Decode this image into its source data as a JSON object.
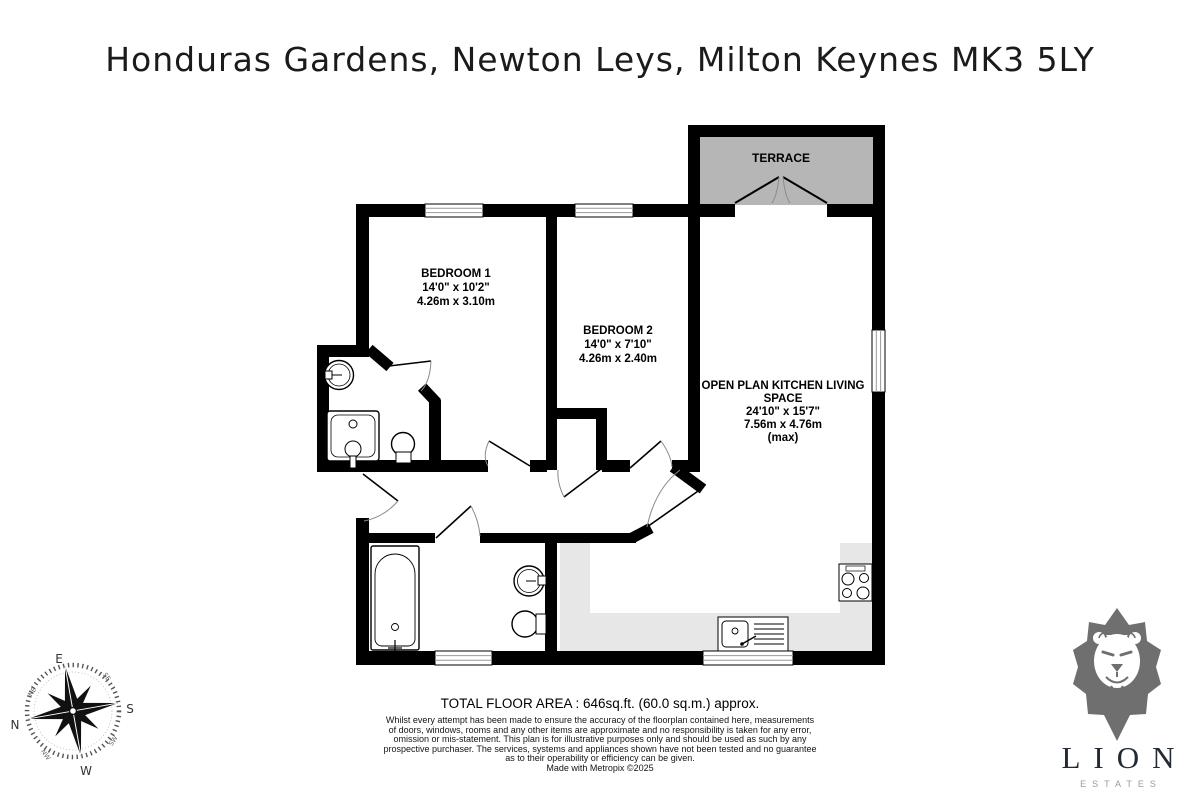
{
  "title": "Honduras Gardens, Newton Leys, Milton Keynes MK3 5LY",
  "floorplan": {
    "terrace": {
      "name": "TERRACE"
    },
    "bedroom1": {
      "name": "BEDROOM 1",
      "imperial": "14'0\"  x 10'2\"",
      "metric": "4.26m  x 3.10m"
    },
    "bedroom2": {
      "name": "BEDROOM 2",
      "imperial": "14'0\"  x 7'10\"",
      "metric": "4.26m  x 2.40m"
    },
    "living": {
      "line1": "OPEN PLAN KITCHEN LIVING",
      "line2": "SPACE",
      "imperial": "24'10\"  x 15'7\"",
      "metric": "7.56m  x 4.76m",
      "max": "(max)"
    }
  },
  "compass": {
    "n": "N",
    "e": "E",
    "s": "S",
    "w": "W",
    "ne": "NE",
    "se": "SE",
    "sw": "SW",
    "nw": "NW"
  },
  "footer": {
    "total_area": "TOTAL FLOOR AREA : 646sq.ft. (60.0 sq.m.) approx.",
    "disclaimer_lines": [
      "Whilst every attempt has been made to ensure the accuracy of the floorplan contained here, measurements",
      "of doors, windows, rooms and any other items are approximate and no responsibility is taken for any error,",
      "omission or mis-statement. This plan is for illustrative purposes only and should be used as such by any",
      "prospective purchaser. The services, systems and appliances shown have not been tested and no guarantee",
      "as to their operability or efficiency can be given."
    ],
    "credit": "Made with Metropix ©2025"
  },
  "logo": {
    "name": "LION",
    "tagline": "ESTATES"
  },
  "colors": {
    "wall": "#000000",
    "terrace_fill": "#b6b6b6",
    "counter_fill": "#e7e7e7",
    "logo_text": "#222a36",
    "lion_gray": "#6f6f6f"
  }
}
